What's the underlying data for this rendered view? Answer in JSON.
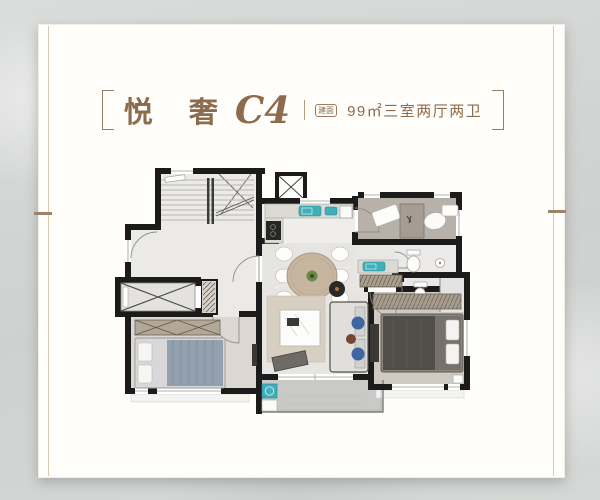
{
  "header": {
    "title_cn": "悦 奢",
    "title_model": "C4",
    "area_badge": "建面",
    "area_text": "99㎡三室两厅两卫"
  },
  "floorplan": {
    "wall_color": "#1b1b1b",
    "accent_teal": "#3fafb8",
    "title_color": "#8d6c4e",
    "card_background": "#fffefa",
    "page_background": "#d2d4d3"
  }
}
